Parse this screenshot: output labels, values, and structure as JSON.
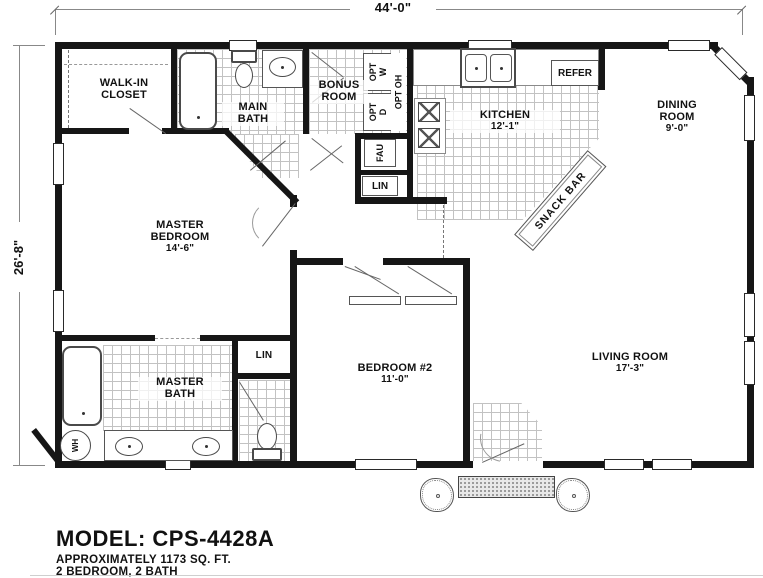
{
  "plan": {
    "dim_width": "44'-0\"",
    "dim_depth": "26'-8\"",
    "rooms": {
      "walk_in_closet": {
        "line1": "WALK-IN",
        "line2": "CLOSET"
      },
      "main_bath": {
        "line1": "MAIN",
        "line2": "BATH"
      },
      "bonus_room": {
        "line1": "BONUS",
        "line2": "ROOM"
      },
      "kitchen": {
        "name": "KITCHEN",
        "dim": "12'-1\""
      },
      "dining_room": {
        "line1": "DINING",
        "line2": "ROOM",
        "dim": "9'-0\""
      },
      "master_bedroom": {
        "line1": "MASTER",
        "line2": "BEDROOM",
        "dim": "14'-6\""
      },
      "master_bath": {
        "line1": "MASTER",
        "line2": "BATH"
      },
      "bedroom_2": {
        "name": "BEDROOM #2",
        "dim": "11'-0\""
      },
      "living_room": {
        "name": "LIVING ROOM",
        "dim": "17'-3\""
      }
    },
    "features": {
      "snack_bar": "SNACK BAR",
      "refrigerator": "REFER",
      "furnace": "FAU",
      "linen_hall": "LIN",
      "linen_bath": "LIN",
      "water_heater": "WH",
      "opt_washer": "OPT W",
      "opt_dryer": "OPT D",
      "opt_overhead": "OPT OH"
    }
  },
  "footer": {
    "model": "MODEL: CPS-4428A",
    "area": "APPROXIMATELY 1173 SQ. FT.",
    "config": "2 BEDROOM, 2 BATH"
  },
  "colors": {
    "wall": "#161616",
    "thin_line": "#666666",
    "tile_line": "#c2c2c2"
  }
}
